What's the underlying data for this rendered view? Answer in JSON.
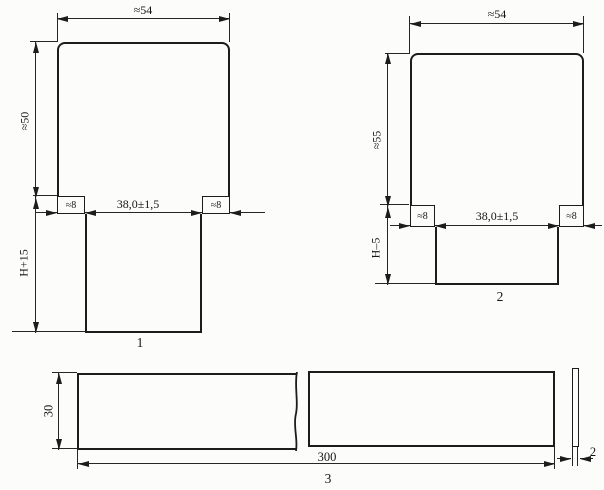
{
  "drawing": {
    "background": "#fcfcfa",
    "line_color": "#1c1c1c",
    "figure1": {
      "label": "1",
      "width_top": "≈54",
      "body_height": "≈50",
      "stem_height": "H+15",
      "tab_left": "≈8",
      "tab_right": "≈8",
      "slot_width": "38,0±1,5"
    },
    "figure2": {
      "label": "2",
      "width_top": "≈54",
      "body_height": "≈55",
      "stem_height": "H–5",
      "tab_left": "≈8",
      "tab_right": "≈8",
      "slot_width": "38,0±1,5"
    },
    "figure3": {
      "label": "3",
      "height": "30",
      "length": "300",
      "thickness": "2"
    }
  }
}
